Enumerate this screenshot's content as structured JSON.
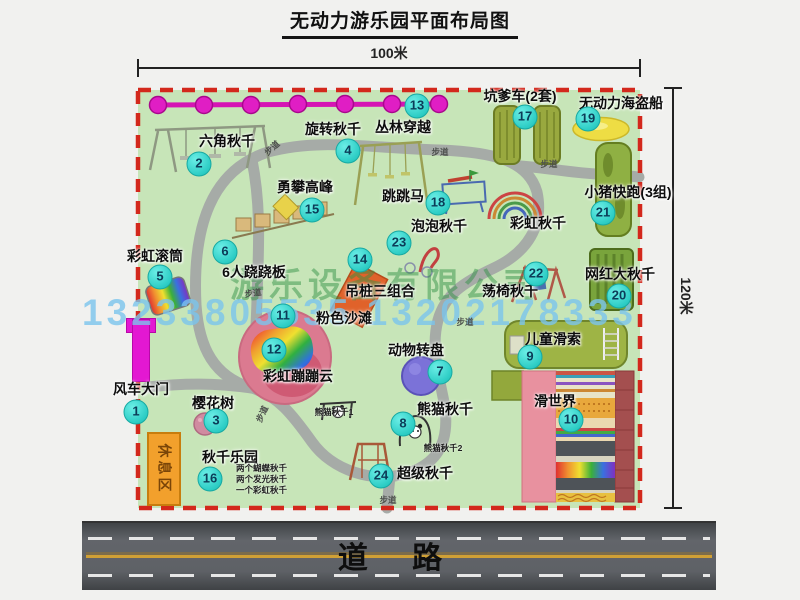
{
  "title": "无动力游乐园平面布局图",
  "dimension": {
    "top": "100米",
    "right": "120米"
  },
  "road_label": "道 路",
  "watermark": {
    "company": "游乐设备有限公司",
    "phone": "13233805535 13202178333"
  },
  "rest_area_label": "休息区",
  "walkway_label": "步道",
  "colors": {
    "park_green": "#c7e5b8",
    "boundary_red": "#d3281c",
    "path_gray": "#a6aba7",
    "badge_cyan": "#2dcdc5",
    "chain_magenta": "#e01ec4",
    "gate_magenta": "#e318d2",
    "rest_orange": "#f2a02c",
    "road_gray": "#5e6166"
  },
  "attractions": [
    {
      "id": "1",
      "label": "风车大门",
      "badge": [
        136,
        412
      ],
      "label_pos": [
        141,
        389
      ]
    },
    {
      "id": "2",
      "label": "六角秋千",
      "badge": [
        199,
        164
      ],
      "label_pos": [
        227,
        141
      ]
    },
    {
      "id": "3",
      "label": "樱花树",
      "badge": [
        216,
        421
      ],
      "label_pos": [
        213,
        403
      ]
    },
    {
      "id": "4",
      "label": "旋转秋千",
      "badge": [
        348,
        151
      ],
      "label_pos": [
        333,
        129
      ]
    },
    {
      "id": "5",
      "label": "彩虹滚筒",
      "badge": [
        160,
        277
      ],
      "label_pos": [
        155,
        256
      ]
    },
    {
      "id": "6",
      "label": "6人跷跷板",
      "badge": [
        225,
        252
      ],
      "label_pos": [
        254,
        272
      ]
    },
    {
      "id": "7",
      "label": "动物转盘",
      "badge": [
        440,
        372
      ],
      "label_pos": [
        416,
        350
      ]
    },
    {
      "id": "8",
      "label": "熊猫秋千",
      "badge": [
        403,
        424
      ],
      "label_pos": [
        445,
        409
      ]
    },
    {
      "id": "9",
      "label": "儿童滑索",
      "badge": [
        530,
        357
      ],
      "label_pos": [
        553,
        339
      ]
    },
    {
      "id": "10",
      "label": "滑世界",
      "badge": [
        571,
        420
      ],
      "label_pos": [
        555,
        401
      ]
    },
    {
      "id": "11",
      "label": "粉色沙滩",
      "badge": [
        283,
        316
      ],
      "label_pos": [
        344,
        318
      ]
    },
    {
      "id": "12",
      "label": "彩虹蹦蹦云",
      "badge": [
        274,
        350
      ],
      "label_pos": [
        298,
        376
      ]
    },
    {
      "id": "13",
      "label": "丛林穿越",
      "badge": [
        417,
        106
      ],
      "label_pos": [
        403,
        127
      ]
    },
    {
      "id": "14",
      "label": "吊桩三组合",
      "badge": [
        360,
        260
      ],
      "label_pos": [
        380,
        291
      ]
    },
    {
      "id": "15",
      "label": "勇攀高峰",
      "badge": [
        312,
        210
      ],
      "label_pos": [
        305,
        187
      ]
    },
    {
      "id": "16",
      "label": "秋千乐园",
      "badge": [
        210,
        479
      ],
      "label_pos": [
        230,
        457
      ],
      "notes": [
        "两个蝴蝶秋千",
        "两个发光秋千",
        "一个彩虹秋千"
      ],
      "notes_pos": [
        236,
        463
      ]
    },
    {
      "id": "17",
      "label": "坑爹车(2套)",
      "badge": [
        525,
        117
      ],
      "label_pos": [
        520,
        96
      ]
    },
    {
      "id": "18",
      "label": "跳跳马",
      "badge": [
        438,
        203
      ],
      "label_pos": [
        403,
        196
      ]
    },
    {
      "id": "19",
      "label": "无动力海盗船",
      "badge": [
        588,
        119
      ],
      "label_pos": [
        621,
        103
      ]
    },
    {
      "id": "20",
      "label": "网红大秋千",
      "badge": [
        619,
        296
      ],
      "label_pos": [
        620,
        274
      ]
    },
    {
      "id": "21",
      "label": "小猪快跑(3组)",
      "badge": [
        603,
        213
      ],
      "label_pos": [
        628,
        192
      ]
    },
    {
      "id": "22",
      "label": "荡椅秋千",
      "badge": [
        536,
        274
      ],
      "label_pos": [
        510,
        291
      ]
    },
    {
      "id": "23",
      "label": "泡泡秋千",
      "badge": [
        399,
        243
      ],
      "label_pos": [
        439,
        226
      ]
    },
    {
      "id": "24",
      "label": "超级秋千",
      "badge": [
        381,
        476
      ],
      "label_pos": [
        425,
        473
      ]
    },
    {
      "id": null,
      "label": "彩虹秋千",
      "badge": null,
      "label_pos": [
        538,
        223
      ]
    }
  ],
  "sub_labels": [
    {
      "text": "熊猫秋千1",
      "x": 334,
      "y": 412
    },
    {
      "text": "熊猫秋千2",
      "x": 443,
      "y": 448
    }
  ],
  "walkways": [
    {
      "x": 272,
      "y": 148,
      "rot": -42
    },
    {
      "x": 440,
      "y": 152,
      "rot": 0
    },
    {
      "x": 549,
      "y": 164,
      "rot": 0
    },
    {
      "x": 253,
      "y": 293,
      "rot": -8
    },
    {
      "x": 465,
      "y": 322,
      "rot": 0
    },
    {
      "x": 262,
      "y": 414,
      "rot": -65
    },
    {
      "x": 388,
      "y": 500,
      "rot": 0
    }
  ]
}
